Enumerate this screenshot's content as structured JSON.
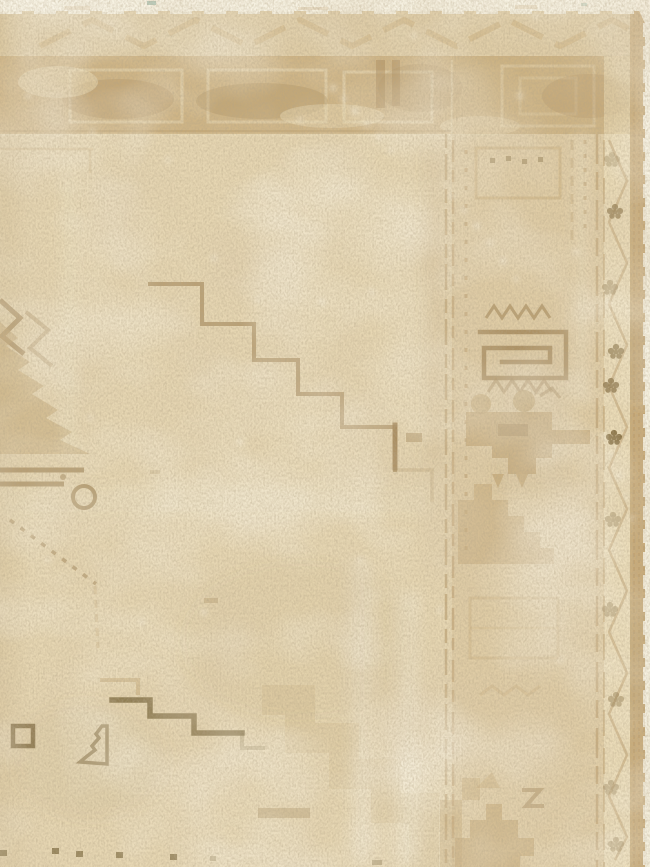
{
  "image": {
    "subject": "Worn vintage beige hand-knotted rug, corner detail photograph",
    "description": "Faded antique rug corner: cream field with stepped medallion outlines, tan main border with ghosted cartouches, right-hand border with square-spiral and hooked geometric motifs, meander vine guard band with dark clover rosettes, tan selvage and white end-finish strips"
  },
  "palette": {
    "paper_white": "#f7f2e2",
    "field": "#e7d7b3",
    "field_shade": "#d9c69e",
    "band_tan": "#c9ac7a",
    "band_shadow": "#a98a5a",
    "guard_cream": "#eee0bc",
    "motif_tan": "#c2a573",
    "motif_mid": "#a08355",
    "motif_dark": "#8a7347",
    "olive_dark": "#7c693f",
    "selvage_tan": "#c5a774",
    "vine_brown": "#b19160",
    "fleck_white": "#faf5e7",
    "teal_speck": "#9ab5a4"
  },
  "features": {
    "top_finish": "white flatweave end strip",
    "chevron_band": "faded diagonal chevron guard band",
    "main_border": "tan band with faded rectangular cartouches and dark wear blotches",
    "right_border": "geometric column: dotted guards, square spiral, zigzag rows, hooked stepped motif",
    "outer_guard": "zigzag meander vine with clover rosettes",
    "selvage": "tan overcast selvage with ragged white edge",
    "field": "open cream field crossed by a thin stepped medallion outline",
    "left_motif": "latch-hook medallion fragment with curled horn bar",
    "bottom_motifs": "olive square, serrated triangle, olive stepped line, faint wide staircase, dark knot dots"
  }
}
